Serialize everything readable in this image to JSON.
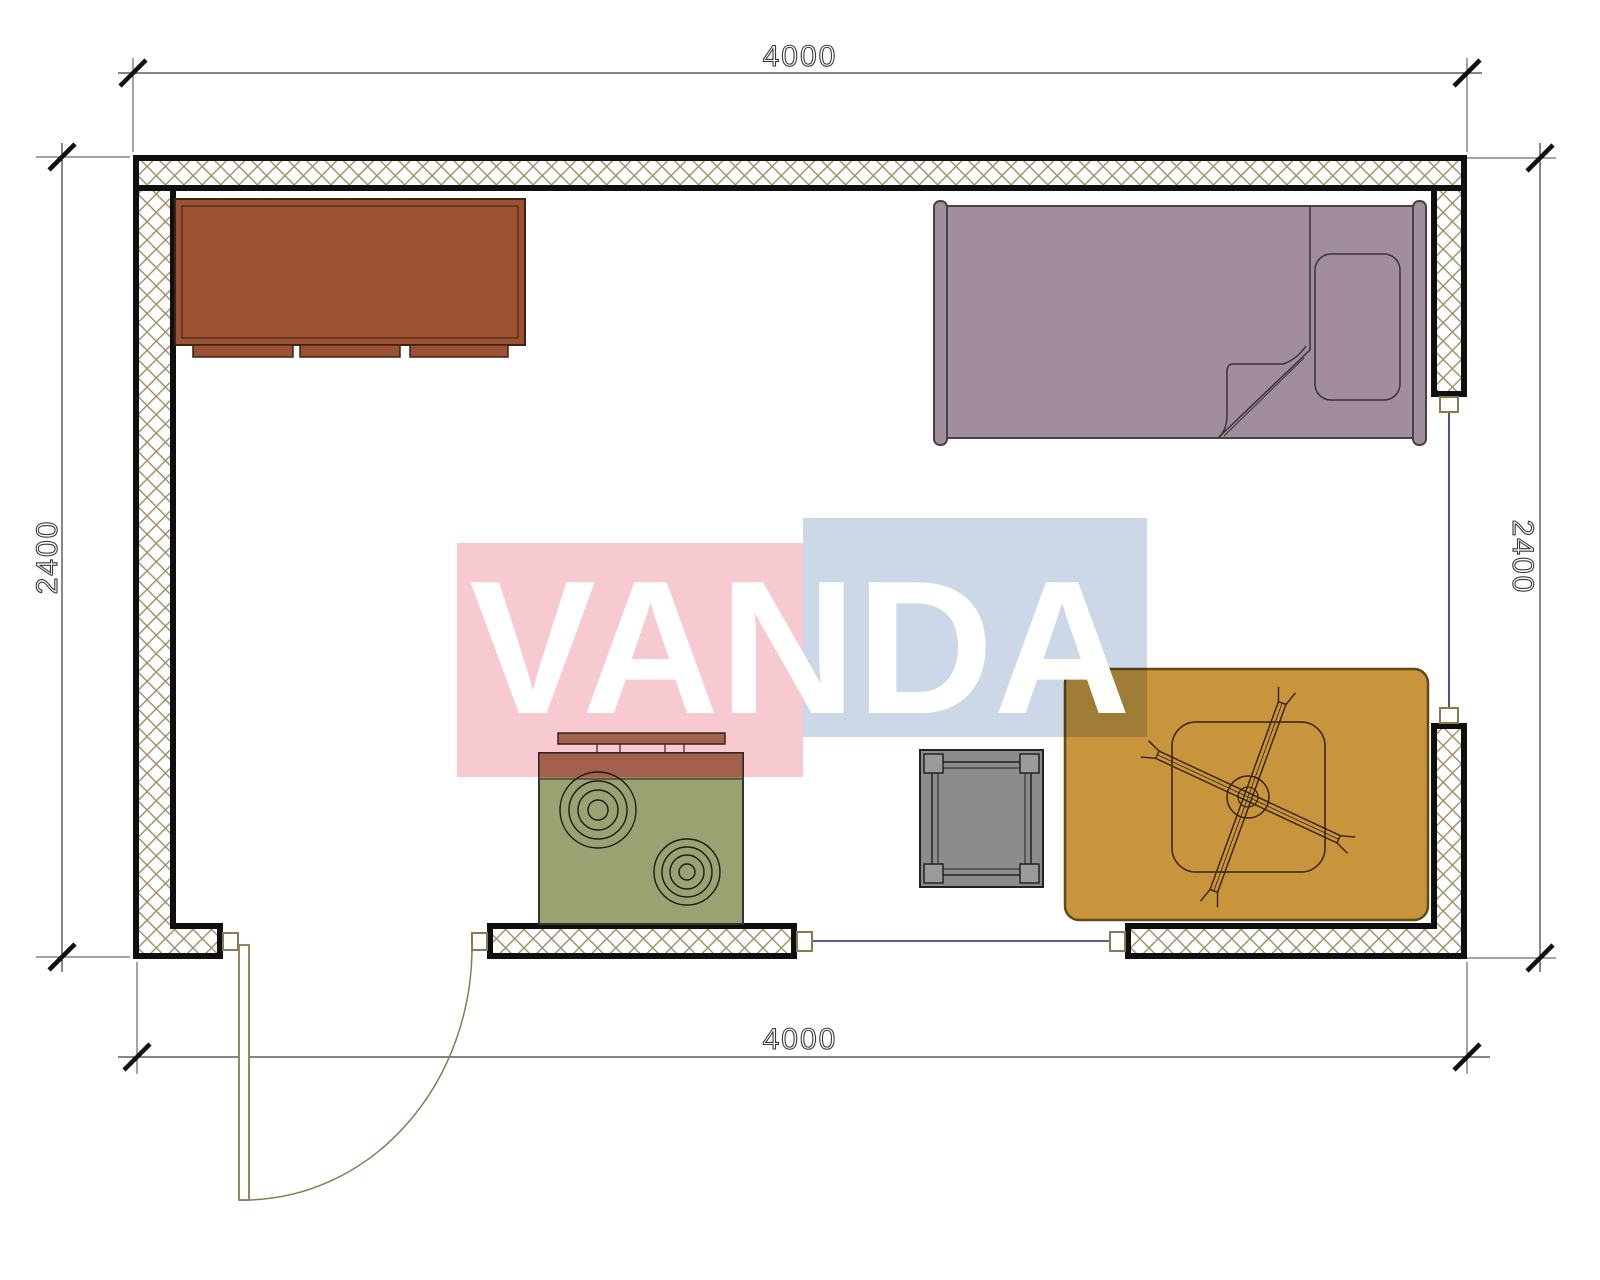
{
  "page": {
    "background": "#ffffff",
    "type": "architectural-floor-plan"
  },
  "dimensions": {
    "top": "4000",
    "bottom": "4000",
    "left": "2400",
    "right": "2400"
  },
  "watermark": {
    "text": "VANDA",
    "pink_color": "#f7c9d0",
    "blue_color": "#ccd8e7",
    "text_color": "#ffffff"
  },
  "colors": {
    "wall_line": "#0f0f0f",
    "hatch": "#9c8e68",
    "dim_line": "#3a3a3a",
    "window_line": "#1c2d5e",
    "door_line": "#8a7a50",
    "dresser": "#9b5132",
    "dresser_edge": "#3a2415",
    "bed": "#a28d9c",
    "bed_edge": "#4a4049",
    "stove_body": "#9aa272",
    "stove_trim": "#a87a5e",
    "table": "#8c8c8c",
    "rug": "#c8943c",
    "rug_edge": "#5f4a18",
    "fan_line": "#332211"
  },
  "symbols": [
    {
      "name": "dresser"
    },
    {
      "name": "single-bed"
    },
    {
      "name": "stove"
    },
    {
      "name": "side-table"
    },
    {
      "name": "rug-with-ceiling-fan"
    },
    {
      "name": "door-swing"
    },
    {
      "name": "window-opening-bottom"
    },
    {
      "name": "window-opening-right"
    }
  ]
}
